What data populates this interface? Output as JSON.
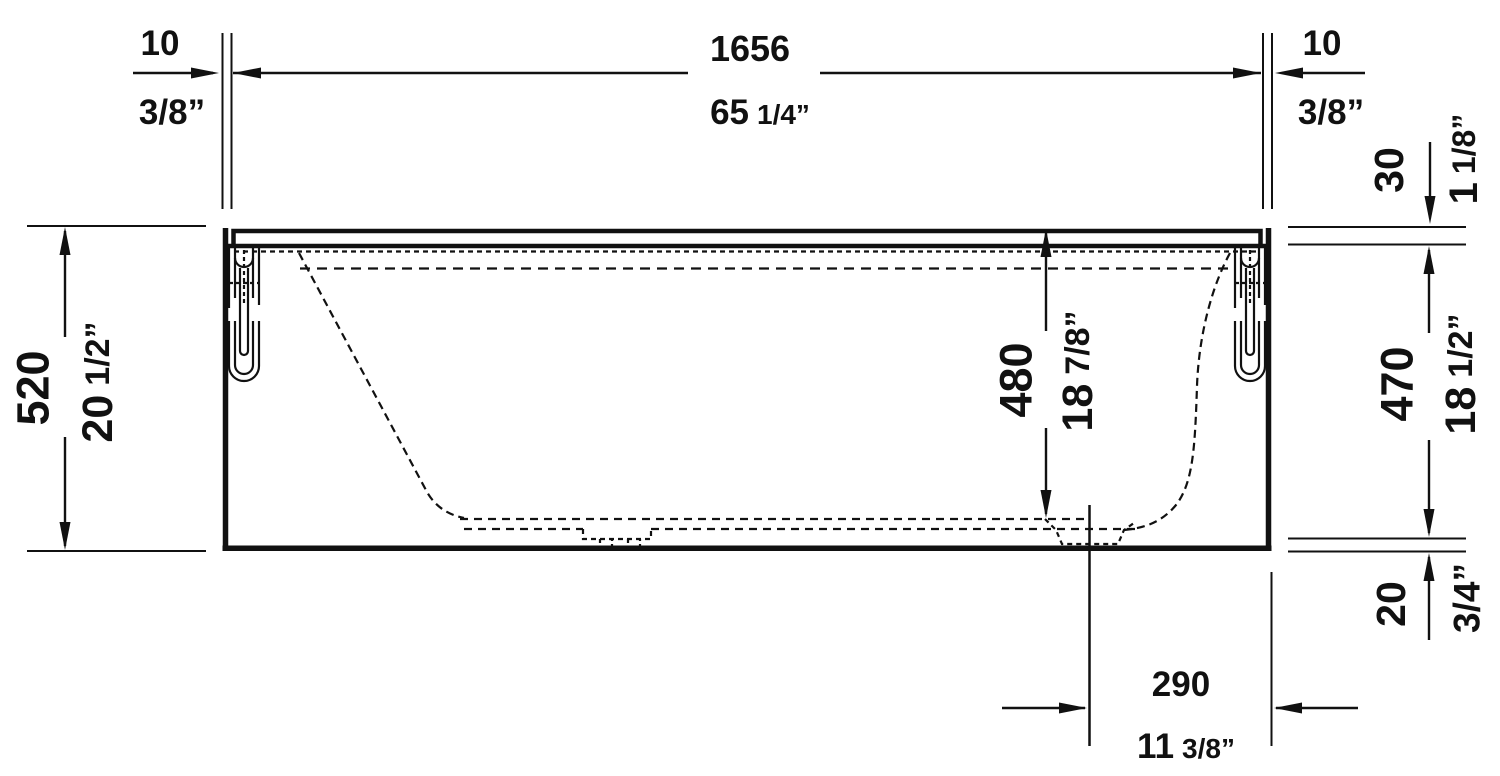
{
  "drawing": {
    "title": "bathtub-side-elevation-dimension-drawing",
    "background": "#ffffff",
    "line_color": "#111111",
    "units": "mm over inches",
    "dimensions": {
      "overall_length": {
        "metric": "1656",
        "imp_main": "65",
        "imp_frac": "1/4”"
      },
      "rim_overhang_left": {
        "metric": "10",
        "imp_main": "3/8”",
        "imp_frac": ""
      },
      "rim_overhang_right": {
        "metric": "10",
        "imp_main": "3/8”",
        "imp_frac": ""
      },
      "overall_height": {
        "metric": "520",
        "imp_main": "20",
        "imp_frac": "1/2”"
      },
      "rim_height": {
        "metric": "30",
        "imp_main": "1",
        "imp_frac": "1/8”"
      },
      "shell_height": {
        "metric": "470",
        "imp_main": "18",
        "imp_frac": "1/2”"
      },
      "base_clearance": {
        "metric": "20",
        "imp_main": "3/4”",
        "imp_frac": ""
      },
      "inner_depth": {
        "metric": "480",
        "imp_main": "18",
        "imp_frac": "7/8”"
      },
      "drain_offset": {
        "metric": "290",
        "imp_main": "11",
        "imp_frac": "3/8”"
      }
    }
  }
}
